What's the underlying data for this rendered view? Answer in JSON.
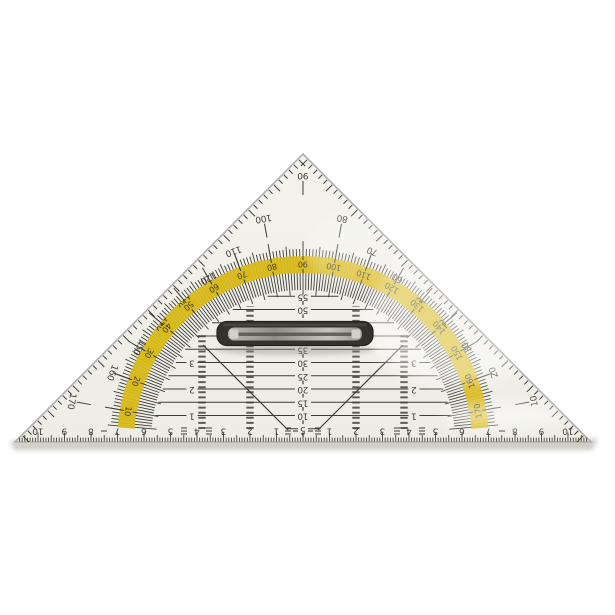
{
  "object": {
    "type": "geometry set square (protractor triangle) with grip handle",
    "description": "Photograph of a transparent 45-degree set square / protractor triangle lying flipped on a white surface: yellow degree arc with two opposing scales, centimetre ruler along the hypotenuse, millimetre centre scale, parallel guide lines, 45-degree guide lines and a black fold-flat grip handle. All printed numbers appear upside down."
  },
  "colors": {
    "background": "#ffffff",
    "body": "#eeede5",
    "body_top": "#f3f2eb",
    "body_edge": "#b2b0a8",
    "print": "#3e3c37",
    "band_yellow": "#d9ba1a",
    "handle_dark": "#34322d",
    "handle_outline": "#23221e",
    "handle_slot_light": "#d2d0c8",
    "shadow": "#c2c0b9"
  },
  "protractor": {
    "unit": "degrees",
    "outer_scale": {
      "labels": [
        10,
        20,
        30,
        40,
        50,
        60,
        70,
        80,
        90,
        100,
        110,
        120,
        130,
        140,
        150,
        160,
        170
      ],
      "direction": "10 at bottom-right edge up to 90 at apex and 170 at bottom-left edge"
    },
    "band_scale": {
      "labels": [
        10,
        20,
        30,
        40,
        50,
        60,
        70,
        80,
        90,
        100,
        110,
        120,
        130,
        140,
        150,
        160,
        170
      ],
      "direction": "10 at bottom-left of yellow arc to 170 at bottom-right"
    },
    "apex_label": "90"
  },
  "hypotenuse_ruler": {
    "unit": "cm",
    "left_numbers": [
      10,
      9,
      8,
      7,
      6,
      5,
      4,
      3,
      2,
      1
    ],
    "zero": "0",
    "right_numbers": [
      1,
      2,
      3,
      4,
      5,
      6,
      7,
      8,
      9,
      10
    ]
  },
  "centre_scale": {
    "unit": "mm",
    "labels": [
      5,
      10,
      15,
      20,
      25,
      30,
      35,
      40,
      45,
      50,
      55
    ]
  },
  "parallel_line_labels": {
    "unit": "cm",
    "left": [
      "1",
      "2",
      "3"
    ],
    "right": [
      "1",
      "2",
      "3"
    ]
  },
  "handle": {
    "label": "grip handle"
  }
}
